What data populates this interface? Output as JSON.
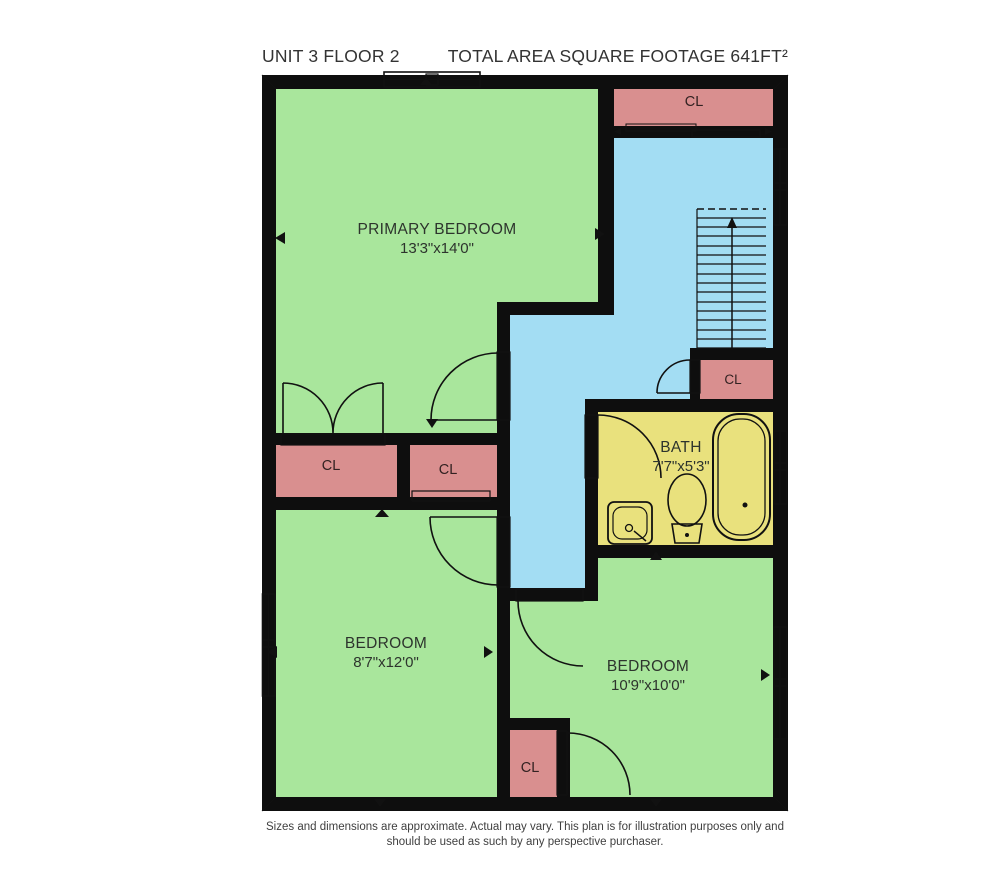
{
  "header": {
    "unit_label": "UNIT 3 FLOOR 2",
    "area_label": "TOTAL AREA SQUARE FOOTAGE 641FT²"
  },
  "rooms": {
    "primary_bedroom": {
      "name": "PRIMARY BEDROOM",
      "dims": "13'3\"x14'0\""
    },
    "bedroom_left": {
      "name": "BEDROOM",
      "dims": "8'7\"x12'0\""
    },
    "bedroom_right": {
      "name": "BEDROOM",
      "dims": "10'9\"x10'0\""
    },
    "bath": {
      "name": "BATH",
      "dims": "7'7\"x5'3\""
    },
    "closet_top_right": {
      "label": "CL"
    },
    "closet_mid_left": {
      "label": "CL"
    },
    "closet_mid_right": {
      "label": "CL"
    },
    "closet_hall": {
      "label": "CL"
    },
    "closet_bottom": {
      "label": "CL"
    }
  },
  "footer": {
    "disclaimer_line1": "Sizes and dimensions are approximate. Actual may vary. This plan is for illustration purposes only and",
    "disclaimer_line2": "should be used as such by any perspective purchaser."
  },
  "colors": {
    "room_green": "#a9e69c",
    "closet_pink": "#d98f8f",
    "hallway_blue": "#a3ddf3",
    "bath_yellow": "#e9e17d",
    "wall_black": "#0e0e0e"
  }
}
